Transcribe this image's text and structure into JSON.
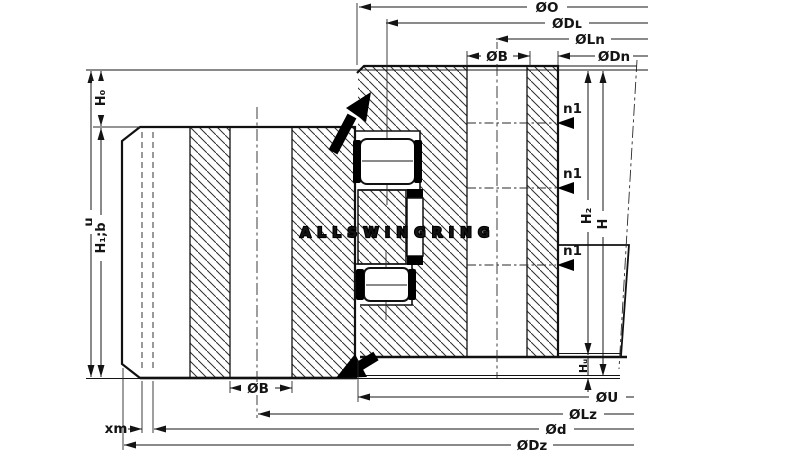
{
  "drawing": {
    "title": "slewing-ring-bearing-cross-section",
    "watermark": "ALLSWINGRING",
    "top_dimensions": {
      "O": "ØO",
      "DL": "ØDʟ",
      "Ln": "ØLn",
      "B": "ØB",
      "Dn": "ØDn"
    },
    "bottom_dimensions": {
      "B": "ØB",
      "U": "ØU",
      "Lz": "ØLz",
      "d": "Ød",
      "Dz": "ØDz",
      "xm": "xm"
    },
    "left_dimensions": {
      "u": "u",
      "H0": "H₀",
      "H1b": "H₁;b"
    },
    "right_dimensions": {
      "H2": "H₂",
      "H": "H",
      "Hu": "Hᵤ"
    },
    "hole_labels": {
      "upper": "n1",
      "middle": "n1",
      "lower": "n1"
    },
    "colors": {
      "line": "#141414",
      "background": "#ffffff",
      "watermark_fill": "#ffffff",
      "watermark_outline": "#000000"
    }
  }
}
